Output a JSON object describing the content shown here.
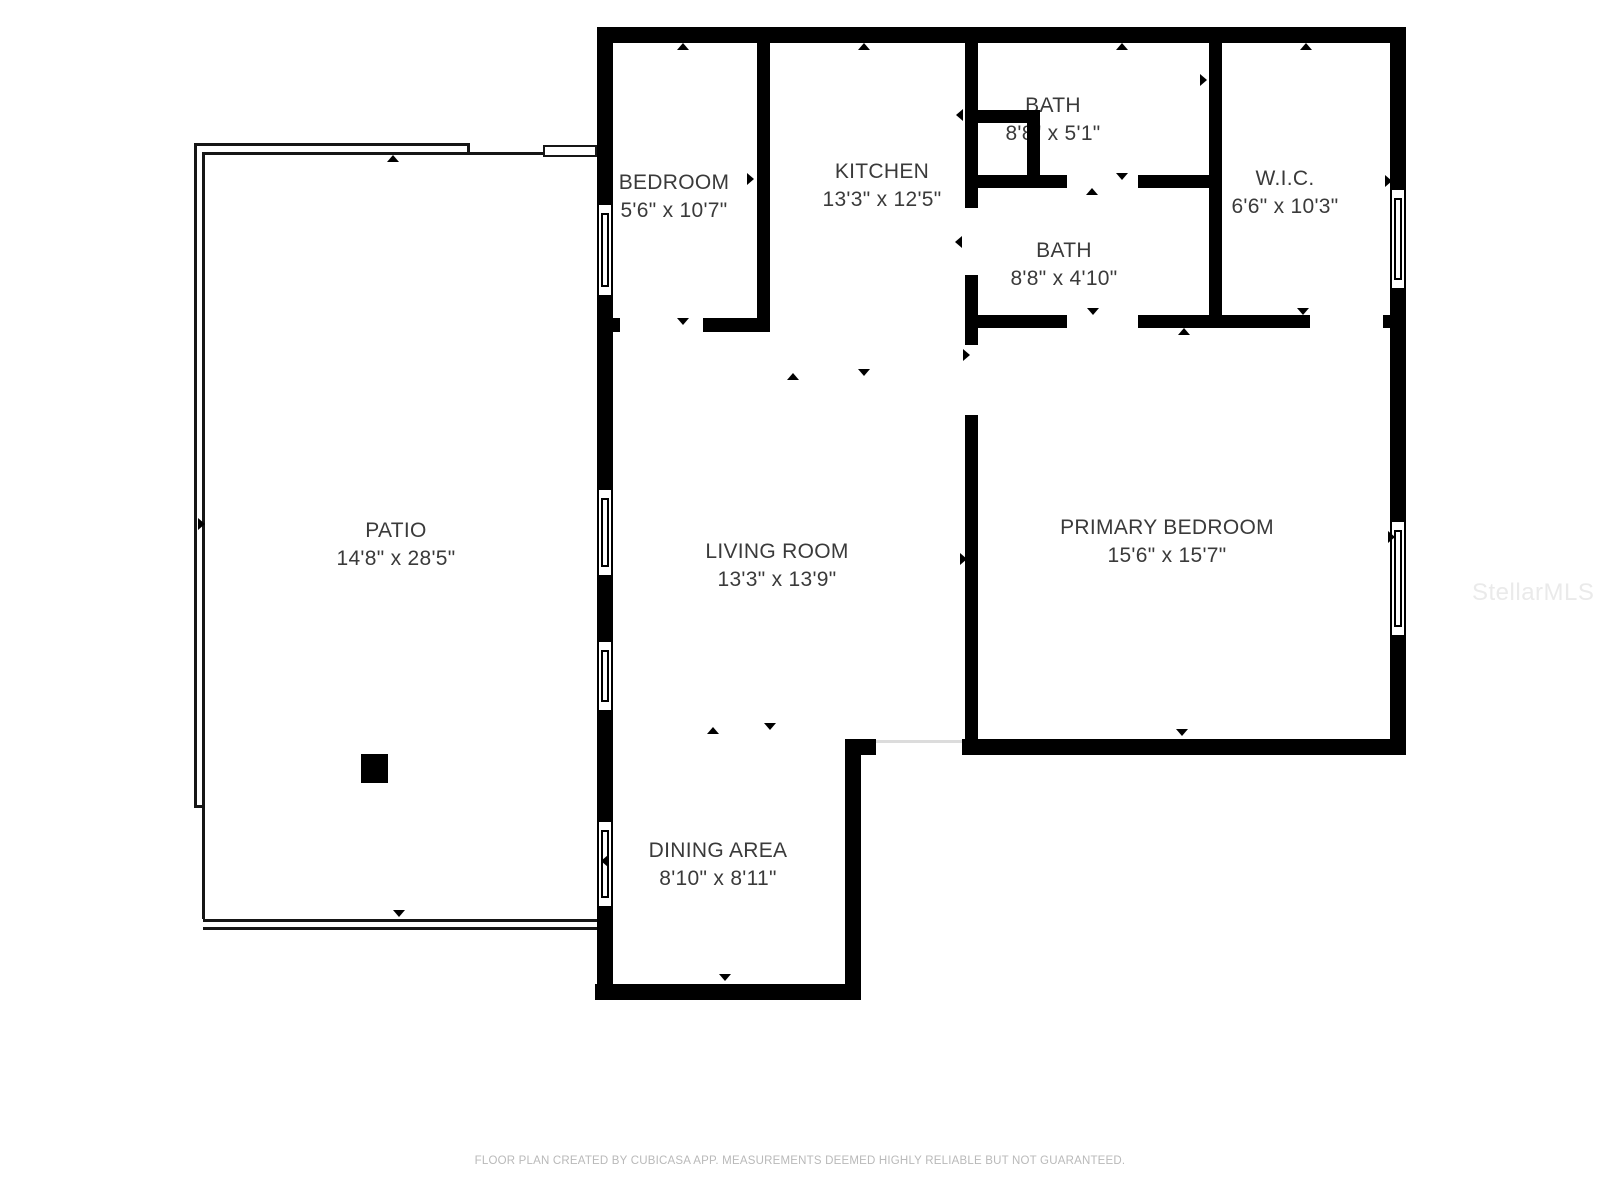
{
  "floorplan": {
    "wall_color": "#000000",
    "background_color": "#ffffff",
    "label_color": "#3a3a3a",
    "rooms": [
      {
        "name": "BEDROOM",
        "dims": "5'6\" x 10'7\""
      },
      {
        "name": "KITCHEN",
        "dims": "13'3\" x 12'5\""
      },
      {
        "name": "BATH",
        "dims": "8'8\" x 5'1\""
      },
      {
        "name": "BATH",
        "dims": "8'8\" x 4'10\""
      },
      {
        "name": "W.I.C.",
        "dims": "6'6\" x 10'3\""
      },
      {
        "name": "LIVING ROOM",
        "dims": "13'3\" x 13'9\""
      },
      {
        "name": "PRIMARY BEDROOM",
        "dims": "15'6\" x 15'7\""
      },
      {
        "name": "DINING AREA",
        "dims": "8'10\" x 8'11\""
      },
      {
        "name": "PATIO",
        "dims": "14'8\" x 28'5\""
      }
    ]
  },
  "watermark": {
    "text": "StellarMLS"
  },
  "footer": {
    "text": "FLOOR PLAN CREATED BY CUBICASA APP. MEASUREMENTS DEEMED HIGHLY RELIABLE BUT NOT GUARANTEED."
  }
}
